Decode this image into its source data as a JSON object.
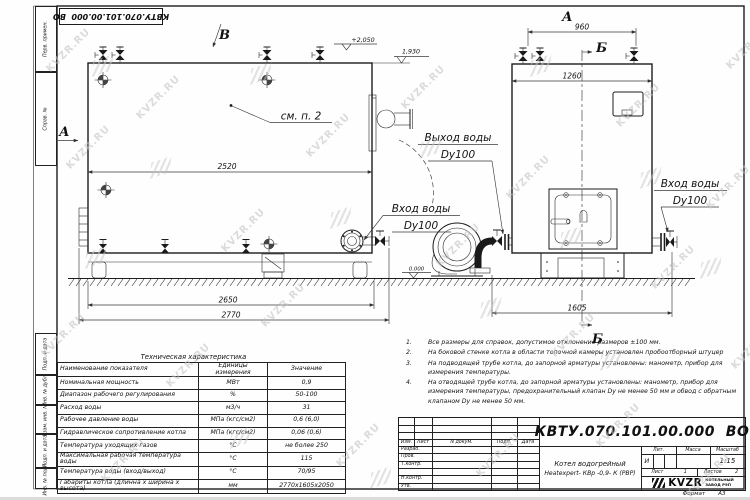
{
  "watermark": {
    "text": "KVZR.RU"
  },
  "stamp_top": {
    "code": "КВТУ.070.101.00.000  ВО"
  },
  "margin_labels": {
    "c1": "Перв. примен.",
    "c2": "Справ. №",
    "c3": "Подп. и дата",
    "c4": "Инв. № дубл.",
    "c5": "Взам. инв. №",
    "c6": "Подп. и дата",
    "c7": "Инв. № подл."
  },
  "views": {
    "label_a_left": "А",
    "label_v": "В",
    "label_a_top": "А",
    "label_b_top": "Б",
    "label_b_bottom": "Б",
    "see_note": "см. п. 2",
    "elev_top": "+2,050",
    "elev_flue": "1,930",
    "elev_zero": "0.000",
    "dim_2520": "2520",
    "dim_2650": "2650",
    "dim_2770": "2770",
    "dim_960": "960",
    "dim_1260": "1260",
    "dim_1605": "1605",
    "outlet_label": "Выход воды",
    "outlet_dn": "Dy100",
    "inlet_label": "Вход воды",
    "inlet_dn": "Dy100",
    "inlet2_label": "Вход воды",
    "inlet2_dn": "Dy100"
  },
  "notes": [
    {
      "num": "1.",
      "text": "Все размеры для справок, допустимое отклонение размеров ±100 мм."
    },
    {
      "num": "2.",
      "text": "На боковой стенке котла в области топочной камеры установлен пробоотборный штуцер"
    },
    {
      "num": "3.",
      "text": "На  подводящей трубе котла, до запорной арматуры установлены: манометр, прибор для измерения температуры."
    },
    {
      "num": "4.",
      "text": "На отводящей трубе котла, до запорной арматуры установлены: манометр, прибор для измерения температуры, предохранительный клапан  Dу не менее 50 мм и обвод с обратным клапаном  Dу не менее 50 мм."
    }
  ],
  "spec_table": {
    "title": "Техническая характеристика",
    "col_name": "Наименование показателя",
    "col_units": "Единицы измерения",
    "col_value": "Значение",
    "rows": [
      {
        "n": "Номинальная мощность",
        "u": "МВт",
        "v": "0,9"
      },
      {
        "n": "Диапазон рабочего регулирования",
        "u": "%",
        "v": "50-100"
      },
      {
        "n": "Расход воды",
        "u": "м3/ч",
        "v": "31"
      },
      {
        "n": "Рабочее давление воды",
        "u": "МПа (кгс/см2)",
        "v": "0,6 (6,0)"
      },
      {
        "n": "Гидравлическое сопротивление котла",
        "u": "МПа (кгс/см2)",
        "v": "0,06 (0,6)"
      },
      {
        "n": "Температура уходящих газов",
        "u": "°С",
        "v": "не более 250"
      },
      {
        "n": "Максимальная рабочая температура воды",
        "u": "°С",
        "v": "115"
      },
      {
        "n": "Температура воды (вход/выход)",
        "u": "°С",
        "v": "70/95"
      },
      {
        "n": "Габариты котла (длинна х ширина х высота)",
        "u": "мм",
        "v": "2770х1605х2050"
      }
    ]
  },
  "title_block": {
    "doc_number": "КВТУ.070.101.00.000  ВО",
    "cols": [
      "Изм.",
      "Лист",
      "N докум.",
      "Подп.",
      "Дата"
    ],
    "roles": [
      "Разраб.",
      "Пров.",
      "Т.контр.",
      "",
      "Н.контр.",
      "Утв."
    ],
    "product_line1": "Котел водогрейный",
    "product_line2": "Heatexpert- КВр -0,9- К (РВР)",
    "lit_label": "Лит.",
    "lit_value": "И",
    "mass_label": "Масса",
    "scale_label": "Масштаб",
    "scale_value": "1:15",
    "sheet_label": "Лист",
    "sheet_value": "1",
    "sheets_label": "Листов",
    "sheets_value": "2",
    "logo_text": "KVZR",
    "company_line1": "КОТЕЛЬНЫЙ",
    "company_line2": "ЗАВОД РЭП",
    "format_label": "Формат",
    "format_value": "А3"
  }
}
